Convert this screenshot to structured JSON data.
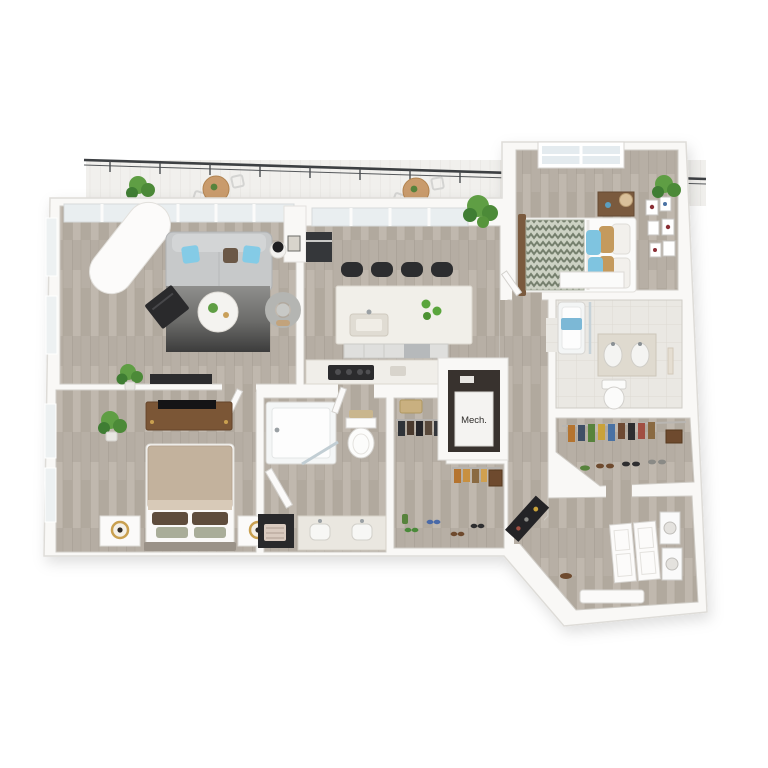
{
  "scene": {
    "description": "3D rendered apartment floor plan viewed from above on a white background",
    "background": "#ffffff"
  },
  "labels": {
    "mech": "Mech."
  },
  "palette": {
    "wall": "#f9f8f6",
    "wall_edge": "#dedcd8",
    "wood": "#b7afa5",
    "wood_dark": "#a39b90",
    "tile": "#e9e7e2",
    "railing": "#3d4043",
    "sofa_gray": "#c7c9ca",
    "pillow_blue": "#84cbe6",
    "pillow_brown": "#6b5847",
    "rug_dark": "#3c3c3c",
    "island_quartz": "#f1efe9",
    "stool_black": "#2c2d2f",
    "cafe_table_wood": "#c99b6c",
    "plant_green": "#5f9e44",
    "plant_green_dark": "#3f7d33",
    "duvet_tan": "#c3b29d",
    "duvet_chevron": "#76806e",
    "accent_blue": "#7cb8d6",
    "furniture_wood": "#7b5636",
    "lamp_gold": "#c9a050",
    "appliance_black": "#2b2b2d",
    "granite": "#dfdacf"
  },
  "rooms": [
    {
      "id": "balcony",
      "features": [
        "black metal railing",
        "2 round cafe tables with chairs",
        "3 potted plants"
      ]
    },
    {
      "id": "living-room",
      "features": [
        "gray sofa with blue and brown pillows",
        "dark gradient rug",
        "round white coffee table with plant",
        "black accent chair",
        "curved lounge chair",
        "white structural column",
        "floor-to-ceiling windows",
        "black media console",
        "wall art"
      ]
    },
    {
      "id": "kitchen",
      "features": [
        "white quartz island with sink",
        "4 black bar stools",
        "green apples on island",
        "cooktop counter",
        "built-in dark appliance",
        "sliding glass balcony doors",
        "palm plant"
      ]
    },
    {
      "id": "bedroom-2",
      "features": [
        "bed with chevron duvet",
        "blue and tan pillows",
        "dark wood nightstand with lamp",
        "gallery wall of six frames",
        "window",
        "low white shelf"
      ]
    },
    {
      "id": "bathroom-2",
      "features": [
        "tub with blue towel",
        "glass shower panel",
        "double-sink vanity",
        "toilet"
      ]
    },
    {
      "id": "walk-in-closet-2",
      "features": [
        "rod of multicolored hanging clothes",
        "row of shoes",
        "brown storage box"
      ]
    },
    {
      "id": "entry",
      "features": [
        "double entry door",
        "stacked washer and dryer",
        "black console table",
        "white bench"
      ]
    },
    {
      "id": "bedroom-1",
      "features": [
        "bed with tan duvet",
        "brown and sage pillows",
        "two white nightstands with gold lamps",
        "wood dresser with TV",
        "palm plant",
        "tall windows",
        "open door"
      ]
    },
    {
      "id": "bathroom-1",
      "features": [
        "alcove tub with glass panel",
        "toilet with towels on tank",
        "double-sink vanity",
        "dark cabinet with woven basket",
        "open doors"
      ]
    },
    {
      "id": "walk-in-closet-1",
      "features": [
        "dark hanging clothes",
        "tan hanging clothes",
        "storage basket",
        "brown box",
        "scattered shoes"
      ]
    },
    {
      "id": "mechanical-closet",
      "features": [
        "white mechanical unit labeled Mech."
      ]
    },
    {
      "id": "hallway",
      "features": [
        "wood plank flooring"
      ]
    }
  ]
}
